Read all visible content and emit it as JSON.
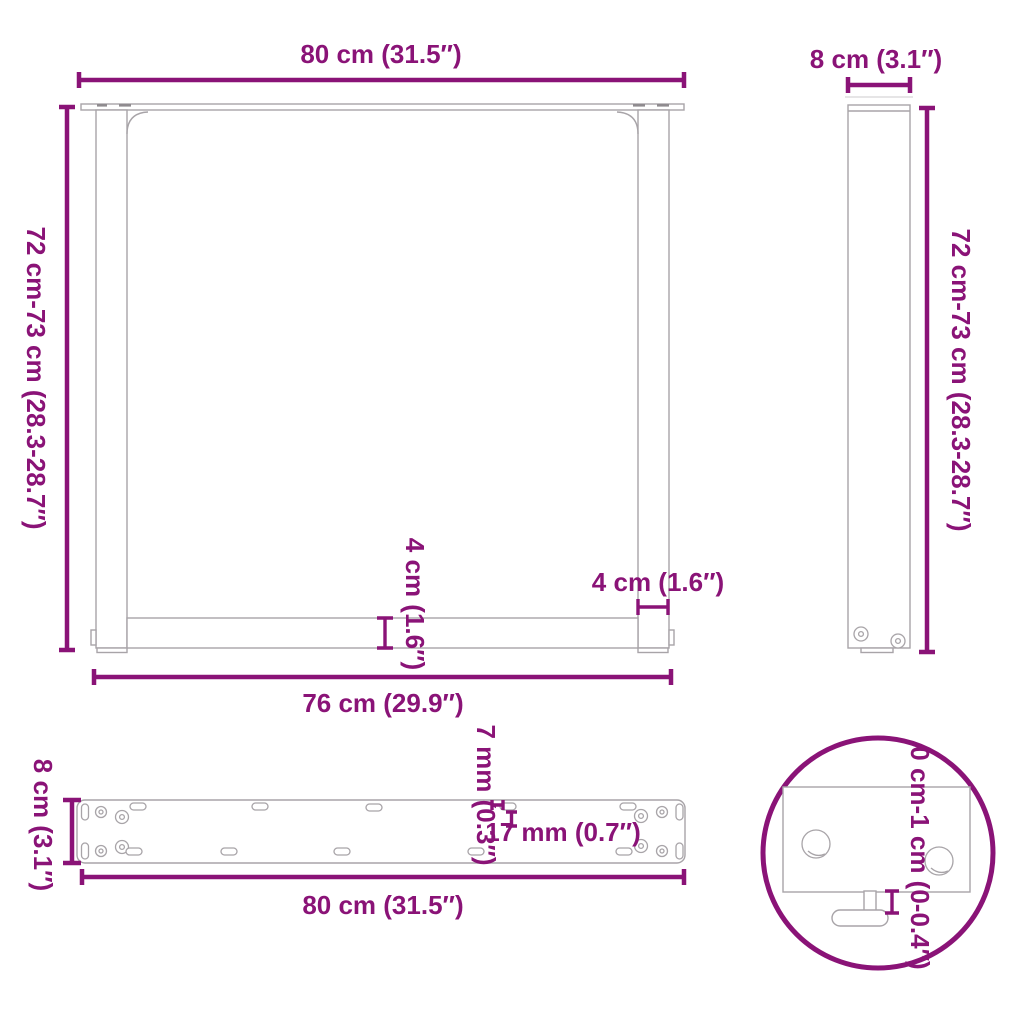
{
  "colors": {
    "accent": "#8A1377",
    "outline": "#A8A4A8"
  },
  "front": {
    "top_width": "80 cm (31.5″)",
    "side_height": "72 cm-73 cm (28.3-28.7″)",
    "inner_width": "76 cm (29.9″)",
    "crossbar_height": "4 cm (1.6″)",
    "leg_width": "4 cm (1.6″)"
  },
  "side": {
    "top_depth": "8 cm (3.1″)",
    "side_height": "72 cm-73 cm (28.3-28.7″)"
  },
  "plate": {
    "left_depth": "8 cm (3.1″)",
    "bottom_width": "80 cm (31.5″)",
    "hole_width": "7 mm (0.3″)",
    "hole_length": "17 mm (0.7″)"
  },
  "detail": {
    "adjustment_range": "0 cm-1 cm (0-0.4″)"
  }
}
